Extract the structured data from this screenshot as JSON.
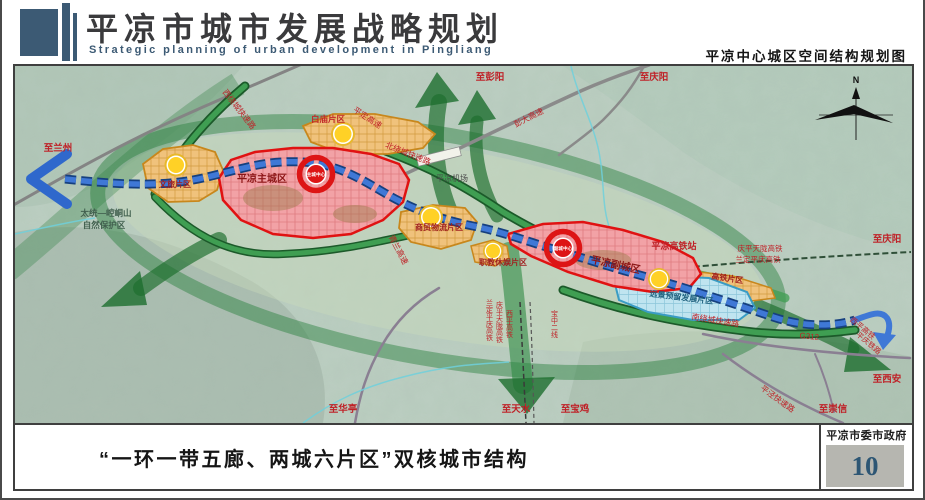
{
  "header": {
    "title": "平凉市城市发展战略规划",
    "subtitle": "Strategic planning of urban development in Pingliang",
    "map_title": "平凉中心城区空间结构规划图"
  },
  "footer": {
    "caption": "“一环一带五廊、两城六片区”双核城市结构",
    "agency": "平凉市委市政府",
    "page_number": "10"
  },
  "colors": {
    "accent_blue": "#3c5a74",
    "city_red": "#dd1515",
    "district_orange": "#cf8a1c",
    "reserve_blue": "#3a9cc4",
    "corridor_green": "#1d6e2e",
    "axis_blue": "#3f78d6"
  },
  "map": {
    "compass": "N",
    "cores": [
      {
        "label": "主城中心"
      },
      {
        "label": "副城中心"
      }
    ],
    "cities": [
      {
        "label": "平凉主城区"
      },
      {
        "label": "平凉副城区"
      }
    ],
    "districts": [
      {
        "label": "文旅片区"
      },
      {
        "label": "白庙片区"
      },
      {
        "label": "商贸物流片区"
      },
      {
        "label": "职教休娱片区"
      },
      {
        "label": "高铁片区"
      },
      {
        "label": "远景预留发展片区"
      }
    ],
    "stations": [
      {
        "label": "平凉高铁站"
      },
      {
        "label": "平凉机场"
      }
    ],
    "reserve": {
      "line1": "太统—崆峒山",
      "line2": "自然保护区"
    },
    "roads": [
      {
        "label": "西绕城快速路"
      },
      {
        "label": "北绕城快速路"
      },
      {
        "label": "南绕城快速路"
      },
      {
        "label": "彭大高速"
      },
      {
        "label": "平定高速"
      },
      {
        "label": "青兰高速"
      },
      {
        "label": "平泾快速路"
      },
      {
        "label": "G312"
      }
    ],
    "railways": {
      "east": [
        {
          "label": "庆平天陇高铁"
        },
        {
          "label": "兰定平庆高铁"
        }
      ],
      "south": [
        {
          "label": "兰定平庆高铁"
        },
        {
          "label": "庆平天陇高铁"
        },
        {
          "label": "西平高铁"
        },
        {
          "label": "宝中二线"
        }
      ],
      "southeast": [
        {
          "label": "西平高铁"
        },
        {
          "label": "平庆铁路"
        }
      ]
    },
    "destinations": [
      {
        "label": "至兰州"
      },
      {
        "label": "至彭阳"
      },
      {
        "label": "至庆阳"
      },
      {
        "label": "至庆阳"
      },
      {
        "label": "至西安"
      },
      {
        "label": "至崇信"
      },
      {
        "label": "至华亭"
      },
      {
        "label": "至天水"
      },
      {
        "label": "至宝鸡"
      }
    ]
  }
}
